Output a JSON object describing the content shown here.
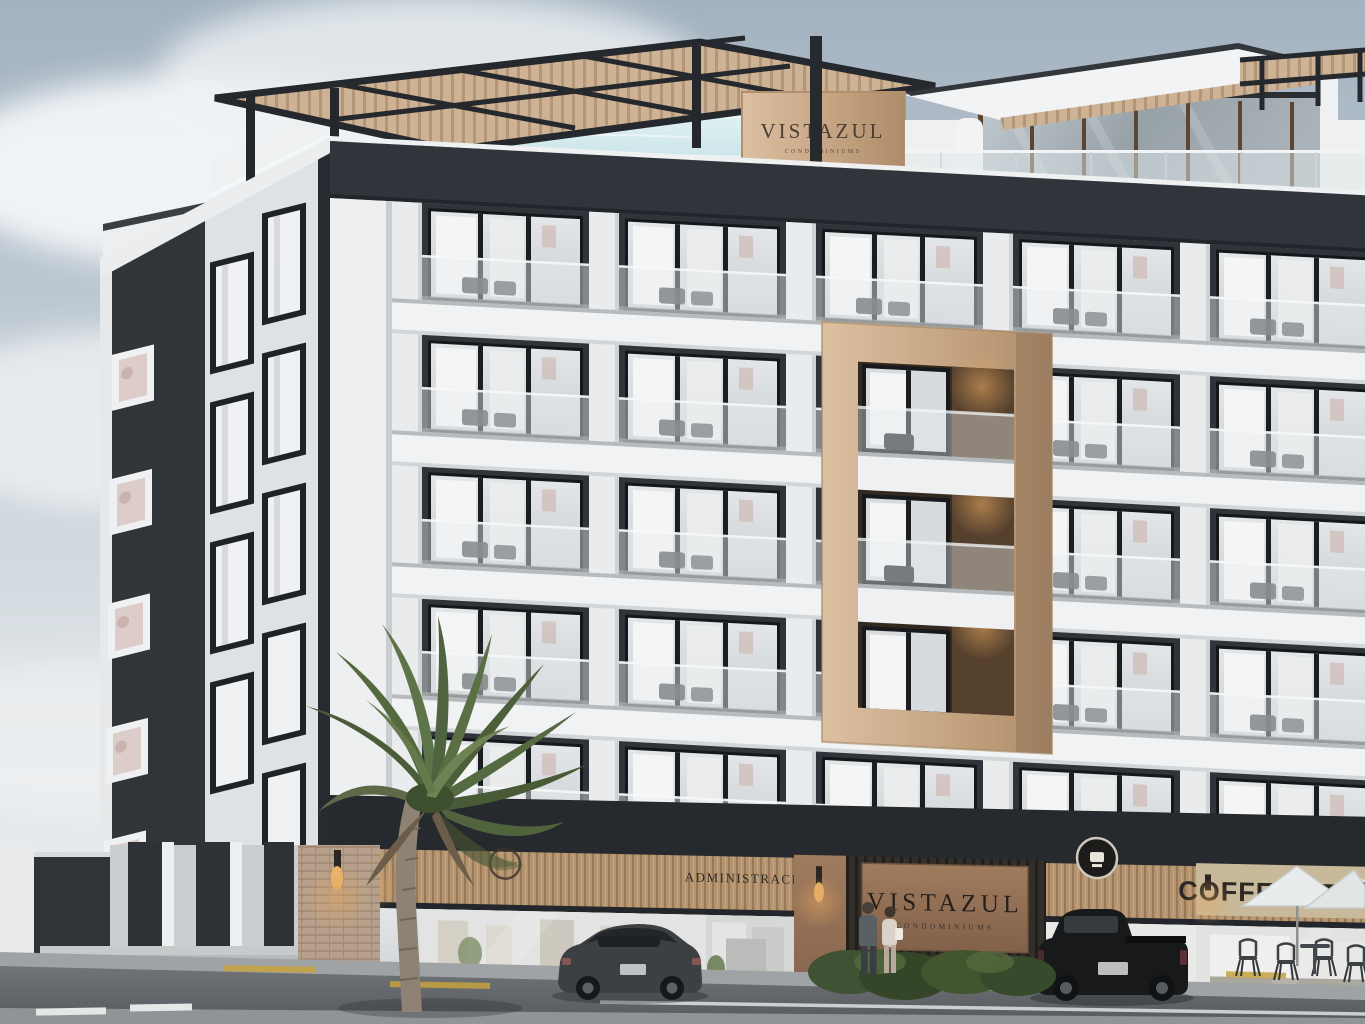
{
  "scene": {
    "title": "Vistazul Condominiums exterior rendering",
    "description": "Architectural rendering of a modern six-level condominium building with charcoal and white facade, wood balcony feature frame, rooftop pool with pergolas and glass penthouse, ground-floor retail, palm tree, two parked vehicles, pedestrians and street cafe seating under an overcast sky."
  },
  "building": {
    "rooftop_sign": {
      "name": "VISTAZUL",
      "subtitle": "CONDOMINIUMS"
    },
    "levels_visible": 6,
    "balconies": "glass balustrades with outdoor chairs",
    "feature": "light-wood framed balcony column",
    "colors": {
      "charcoal": "#2f343a",
      "white": "#f0f2f3",
      "wood": "#c6a484",
      "pool": "#cfe9ec"
    }
  },
  "storefronts": {
    "admin_sign": "ADMINISTRACIÓN",
    "entrance_sign": {
      "name": "VISTAZUL",
      "subtitle": "CONDOMINIUMS"
    },
    "coffee_sign": "COFFEE STAR",
    "badges": [
      "shop-ring-logo",
      "coffee-star-badge"
    ]
  },
  "street": {
    "vehicles": [
      "gray hatchback",
      "black pickup truck"
    ],
    "pedestrians": 2,
    "cafe": "white umbrellas with metal chairs",
    "markings": [
      "white lane dashes",
      "yellow curb strips"
    ]
  }
}
